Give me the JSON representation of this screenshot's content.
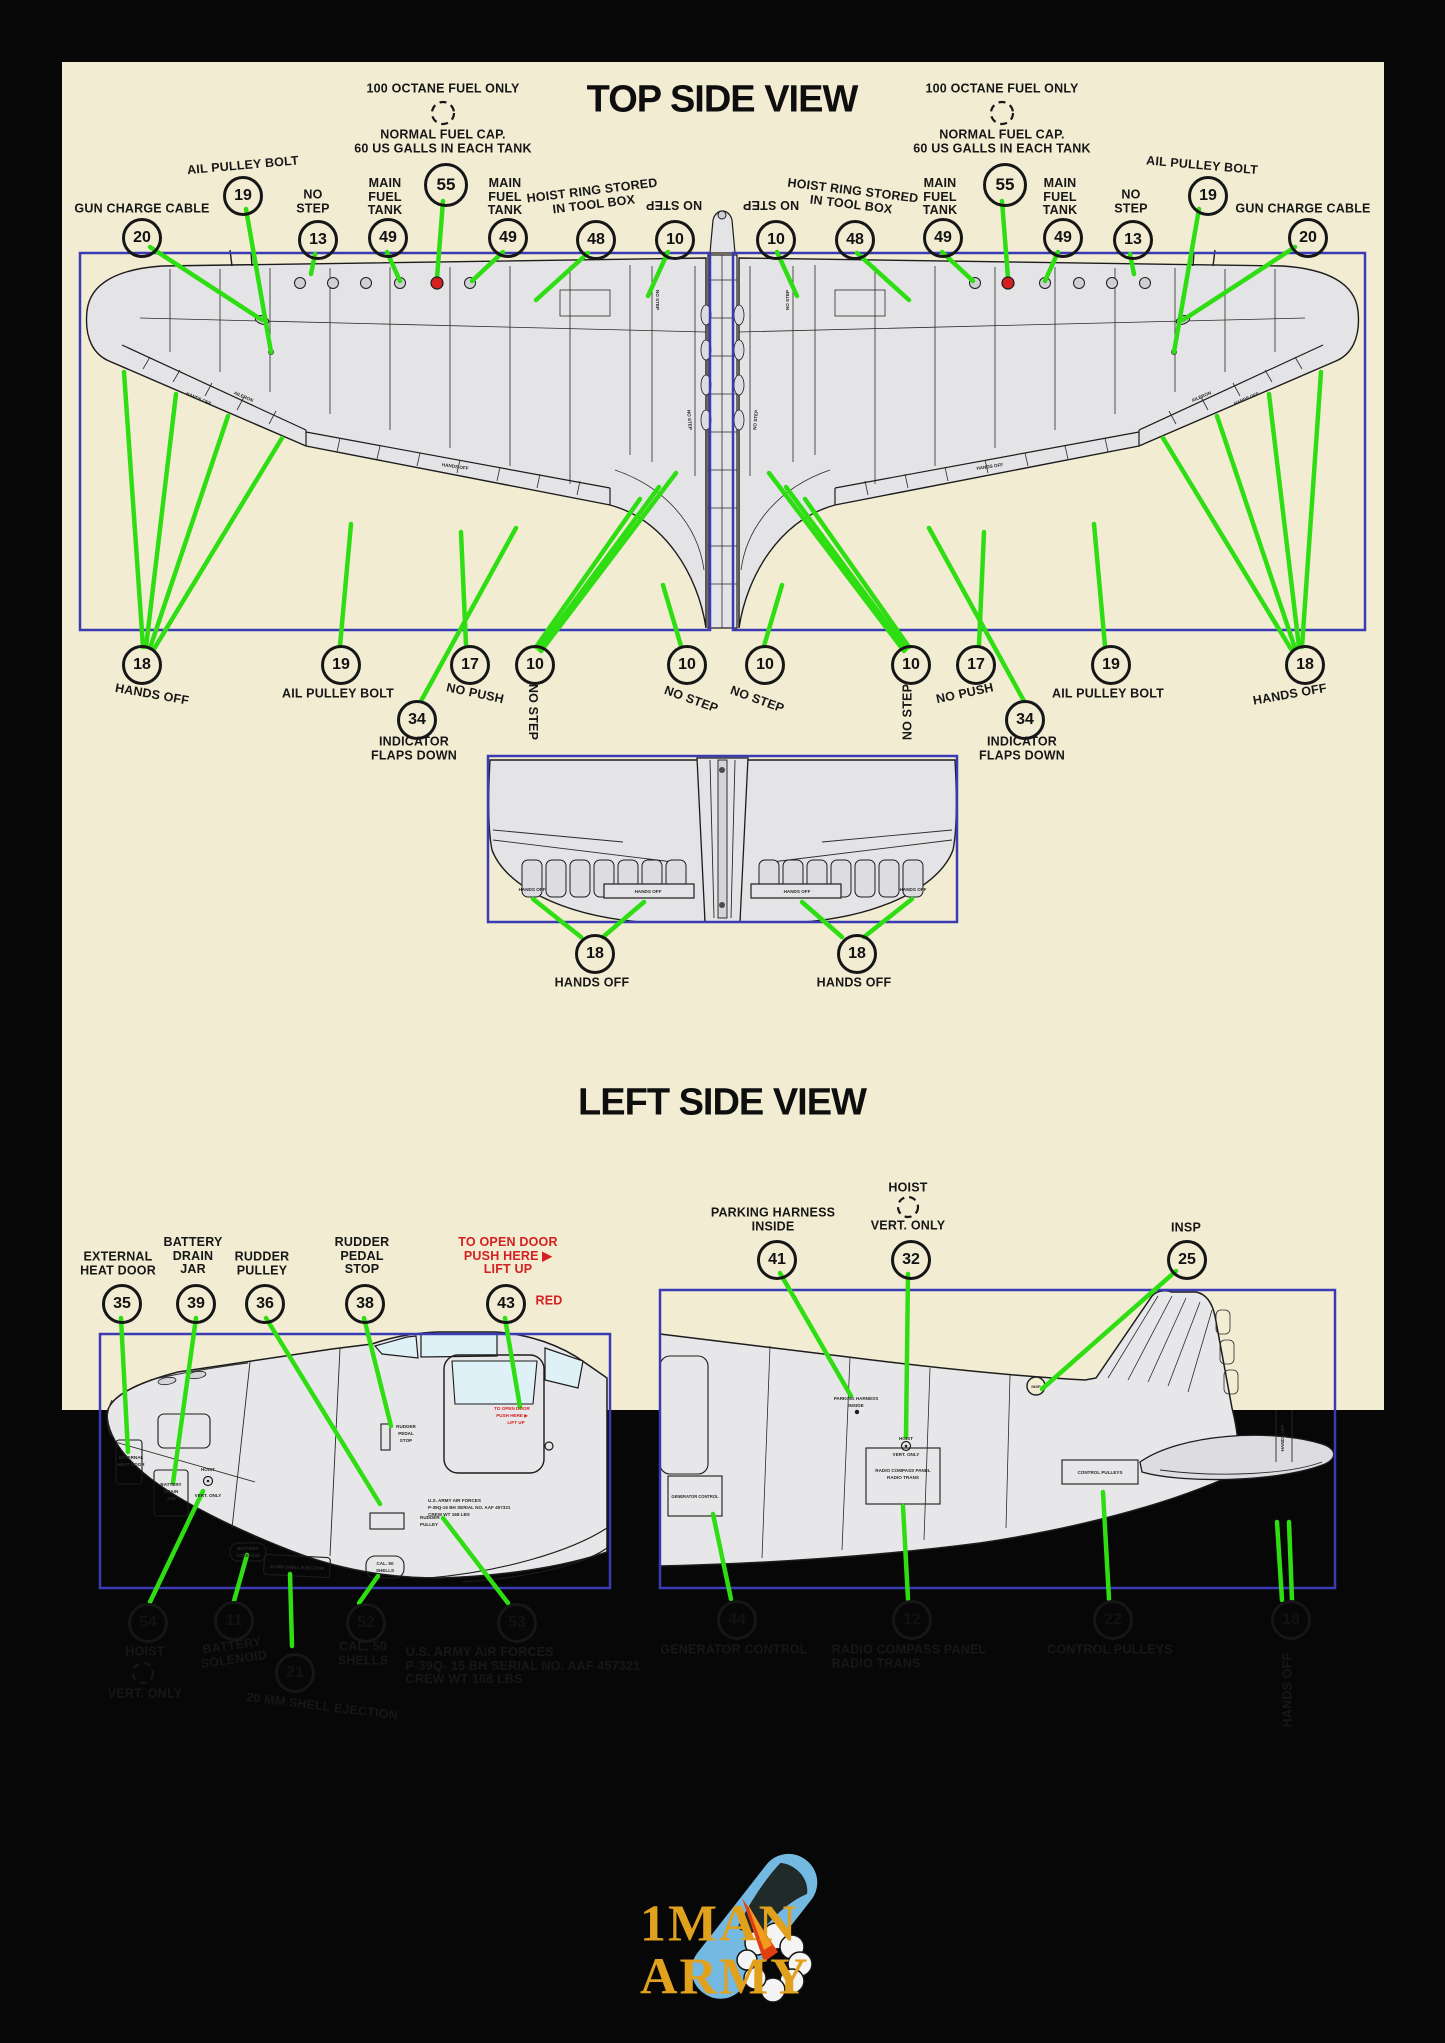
{
  "colors": {
    "bg": "#070707",
    "panel": "#f2ecd3",
    "box_blue": "#3a3ab5",
    "leader_green": "#2fde12",
    "red": "#d42020",
    "ink": "#171717",
    "drawing_gray": "#e4e4e7",
    "logo_gold": "#e2a11d",
    "bomb_blue": "#74b9e2"
  },
  "titles": {
    "top": "TOP SIDE VIEW",
    "left": "LEFT SIDE VIEW"
  },
  "logo": {
    "word1": "1MAN",
    "word2": "ARMY"
  },
  "callouts": [
    {
      "n": "20",
      "x": 139,
      "y": 235
    },
    {
      "n": "19",
      "x": 240,
      "y": 193
    },
    {
      "n": "13",
      "x": 315,
      "y": 237
    },
    {
      "n": "49",
      "x": 385,
      "y": 235
    },
    {
      "n": "55",
      "x": 443,
      "y": 182,
      "d": 38
    },
    {
      "n": "49",
      "x": 505,
      "y": 235
    },
    {
      "n": "48",
      "x": 593,
      "y": 237
    },
    {
      "n": "10",
      "x": 672,
      "y": 237
    },
    {
      "n": "10",
      "x": 773,
      "y": 237
    },
    {
      "n": "48",
      "x": 852,
      "y": 237
    },
    {
      "n": "49",
      "x": 940,
      "y": 235
    },
    {
      "n": "55",
      "x": 1002,
      "y": 182,
      "d": 38
    },
    {
      "n": "49",
      "x": 1060,
      "y": 235
    },
    {
      "n": "13",
      "x": 1130,
      "y": 237
    },
    {
      "n": "19",
      "x": 1205,
      "y": 193
    },
    {
      "n": "20",
      "x": 1305,
      "y": 235
    },
    {
      "n": "18",
      "x": 139,
      "y": 662
    },
    {
      "n": "19",
      "x": 338,
      "y": 662
    },
    {
      "n": "34",
      "x": 414,
      "y": 717
    },
    {
      "n": "17",
      "x": 467,
      "y": 662
    },
    {
      "n": "10",
      "x": 532,
      "y": 662
    },
    {
      "n": "10",
      "x": 684,
      "y": 662
    },
    {
      "n": "10",
      "x": 762,
      "y": 662
    },
    {
      "n": "10",
      "x": 908,
      "y": 662
    },
    {
      "n": "17",
      "x": 973,
      "y": 662
    },
    {
      "n": "34",
      "x": 1022,
      "y": 717
    },
    {
      "n": "19",
      "x": 1108,
      "y": 662
    },
    {
      "n": "18",
      "x": 1302,
      "y": 662
    },
    {
      "n": "18",
      "x": 592,
      "y": 951
    },
    {
      "n": "18",
      "x": 854,
      "y": 951
    },
    {
      "n": "35",
      "x": 119,
      "y": 1301
    },
    {
      "n": "39",
      "x": 193,
      "y": 1301
    },
    {
      "n": "36",
      "x": 262,
      "y": 1301
    },
    {
      "n": "38",
      "x": 362,
      "y": 1301
    },
    {
      "n": "43",
      "x": 503,
      "y": 1301
    },
    {
      "n": "41",
      "x": 774,
      "y": 1257
    },
    {
      "n": "32",
      "x": 908,
      "y": 1257
    },
    {
      "n": "25",
      "x": 1184,
      "y": 1257
    },
    {
      "n": "54",
      "x": 145,
      "y": 1620
    },
    {
      "n": "11",
      "x": 231,
      "y": 1618
    },
    {
      "n": "21",
      "x": 292,
      "y": 1670
    },
    {
      "n": "52",
      "x": 363,
      "y": 1620
    },
    {
      "n": "53",
      "x": 514,
      "y": 1620
    },
    {
      "n": "44",
      "x": 734,
      "y": 1617
    },
    {
      "n": "12",
      "x": 909,
      "y": 1617
    },
    {
      "n": "22",
      "x": 1110,
      "y": 1617
    },
    {
      "n": "18",
      "x": 1288,
      "y": 1617
    }
  ],
  "labels": [
    {
      "t": "100 OCTANE FUEL ONLY",
      "x": 443,
      "y": 89
    },
    {
      "t": "100 OCTANE FUEL ONLY",
      "x": 1002,
      "y": 89
    },
    {
      "t": "NORMAL FUEL CAP.\n60 US GALLS IN EACH TANK",
      "x": 443,
      "y": 142
    },
    {
      "t": "NORMAL FUEL CAP.\n60 US GALLS IN EACH TANK",
      "x": 1002,
      "y": 142
    },
    {
      "t": "AIL PULLEY BOLT",
      "x": 243,
      "y": 166,
      "r": -5
    },
    {
      "t": "AIL PULLEY BOLT",
      "x": 1202,
      "y": 166,
      "r": 5
    },
    {
      "t": "GUN CHARGE CABLE",
      "x": 142,
      "y": 209
    },
    {
      "t": "GUN CHARGE CABLE",
      "x": 1303,
      "y": 209
    },
    {
      "t": "NO\nSTEP",
      "x": 313,
      "y": 202
    },
    {
      "t": "NO\nSTEP",
      "x": 1131,
      "y": 202
    },
    {
      "t": "MAIN\nFUEL\nTANK",
      "x": 385,
      "y": 197
    },
    {
      "t": "MAIN\nFUEL\nTANK",
      "x": 505,
      "y": 197
    },
    {
      "t": "MAIN\nFUEL\nTANK",
      "x": 940,
      "y": 197
    },
    {
      "t": "MAIN\nFUEL\nTANK",
      "x": 1060,
      "y": 197
    },
    {
      "t": "HOIST RING STORED\nIN TOOL BOX",
      "x": 593,
      "y": 198,
      "r": -7
    },
    {
      "t": "HOIST RING STORED\nIN TOOL BOX",
      "x": 852,
      "y": 198,
      "r": 7
    },
    {
      "t": "NO STEP",
      "x": 674,
      "y": 204,
      "r": 180
    },
    {
      "t": "NO STEP",
      "x": 771,
      "y": 204,
      "r": 180
    },
    {
      "t": "HANDS OFF",
      "x": 152,
      "y": 695,
      "r": 10
    },
    {
      "t": "HANDS OFF",
      "x": 1290,
      "y": 695,
      "r": -10
    },
    {
      "t": "AIL PULLEY BOLT",
      "x": 338,
      "y": 694
    },
    {
      "t": "AIL PULLEY BOLT",
      "x": 1108,
      "y": 694
    },
    {
      "t": "NO PUSH",
      "x": 475,
      "y": 694,
      "r": 12
    },
    {
      "t": "NO PUSH",
      "x": 965,
      "y": 694,
      "r": -12
    },
    {
      "t": "NO STEP",
      "x": 532,
      "y": 712,
      "r": 90
    },
    {
      "t": "NO STEP",
      "x": 908,
      "y": 712,
      "r": -90
    },
    {
      "t": "NO STEP",
      "x": 691,
      "y": 700,
      "r": 20
    },
    {
      "t": "NO STEP",
      "x": 757,
      "y": 700,
      "r": 20
    },
    {
      "t": "INDICATOR\nFLAPS DOWN",
      "x": 414,
      "y": 749
    },
    {
      "t": "INDICATOR\nFLAPS DOWN",
      "x": 1022,
      "y": 749
    },
    {
      "t": "HANDS OFF",
      "x": 592,
      "y": 983
    },
    {
      "t": "HANDS OFF",
      "x": 854,
      "y": 983
    },
    {
      "t": "EXTERNAL\nHEAT DOOR",
      "x": 118,
      "y": 1264
    },
    {
      "t": "BATTERY\nDRAIN\nJAR",
      "x": 193,
      "y": 1256
    },
    {
      "t": "RUDDER\nPULLEY",
      "x": 262,
      "y": 1264
    },
    {
      "t": "RUDDER\nPEDAL\nSTOP",
      "x": 362,
      "y": 1256
    },
    {
      "t": "TO OPEN DOOR\nPUSH HERE ▶\nLIFT UP",
      "x": 508,
      "y": 1256,
      "c": "red"
    },
    {
      "t": "RED",
      "x": 549,
      "y": 1301,
      "c": "red"
    },
    {
      "t": "PARKING HARNESS\nINSIDE",
      "x": 773,
      "y": 1220
    },
    {
      "t": "HOIST",
      "x": 908,
      "y": 1188
    },
    {
      "t": "VERT. ONLY",
      "x": 908,
      "y": 1226
    },
    {
      "t": "INSP",
      "x": 1186,
      "y": 1228
    },
    {
      "t": "HOIST",
      "x": 145,
      "y": 1652
    },
    {
      "t": "VERT. ONLY",
      "x": 145,
      "y": 1694
    },
    {
      "t": "BATTERY\nSOLENOID",
      "x": 233,
      "y": 1653,
      "r": -8
    },
    {
      "t": "20 MM SHELL EJECTION",
      "x": 322,
      "y": 1707,
      "r": 7
    },
    {
      "t": "CAL. 50\nSHELLS",
      "x": 363,
      "y": 1654
    },
    {
      "t": "U.S. ARMY AIR FORCES\nP-39Q- 15 BH SERIAL NO. AAF 457321\nCREW WT  168 LBS",
      "x": 523,
      "y": 1666,
      "a": "left"
    },
    {
      "t": "GENERATOR CONTROL",
      "x": 734,
      "y": 1650
    },
    {
      "t": "RADIO COMPASS PANEL\nRADIO TRANS",
      "x": 909,
      "y": 1657,
      "a": "left"
    },
    {
      "t": "CONTROL PULLEYS",
      "x": 1110,
      "y": 1650
    },
    {
      "t": "HANDS OFF",
      "x": 1288,
      "y": 1690,
      "r": -90
    }
  ],
  "leader_lines": [
    [
      150,
      247,
      262,
      320
    ],
    [
      246,
      209,
      271,
      352
    ],
    [
      315,
      254,
      311,
      274
    ],
    [
      387,
      252,
      400,
      281
    ],
    [
      443,
      201,
      437,
      278
    ],
    [
      503,
      252,
      472,
      281
    ],
    [
      588,
      253,
      536,
      300
    ],
    [
      668,
      252,
      648,
      296
    ],
    [
      777,
      252,
      797,
      296
    ],
    [
      857,
      253,
      909,
      300
    ],
    [
      942,
      252,
      973,
      281
    ],
    [
      1002,
      201,
      1008,
      278
    ],
    [
      1058,
      252,
      1045,
      281
    ],
    [
      1130,
      254,
      1134,
      274
    ],
    [
      1199,
      209,
      1174,
      352
    ],
    [
      1295,
      247,
      1183,
      320
    ],
    [
      143,
      647,
      124,
      372
    ],
    [
      146,
      647,
      176,
      394
    ],
    [
      150,
      648,
      228,
      416
    ],
    [
      154,
      649,
      282,
      438
    ],
    [
      340,
      646,
      351,
      524
    ],
    [
      421,
      701,
      516,
      528
    ],
    [
      466,
      645,
      461,
      532
    ],
    [
      536,
      647,
      640,
      499
    ],
    [
      539,
      649,
      659,
      487
    ],
    [
      541,
      651,
      676,
      473
    ],
    [
      681,
      646,
      663,
      585
    ],
    [
      764,
      646,
      782,
      585
    ],
    [
      909,
      647,
      805,
      499
    ],
    [
      906,
      649,
      786,
      487
    ],
    [
      904,
      651,
      769,
      473
    ],
    [
      979,
      645,
      984,
      532
    ],
    [
      1024,
      701,
      929,
      528
    ],
    [
      1105,
      646,
      1094,
      524
    ],
    [
      1302,
      647,
      1321,
      372
    ],
    [
      1299,
      647,
      1269,
      394
    ],
    [
      1295,
      648,
      1217,
      416
    ],
    [
      1291,
      649,
      1163,
      438
    ],
    [
      581,
      937,
      533,
      899
    ],
    [
      603,
      937,
      644,
      902
    ],
    [
      842,
      937,
      802,
      902
    ],
    [
      864,
      937,
      912,
      899
    ],
    [
      121,
      1318,
      128,
      1452
    ],
    [
      196,
      1318,
      173,
      1483
    ],
    [
      266,
      1318,
      380,
      1504
    ],
    [
      364,
      1318,
      391,
      1426
    ],
    [
      505,
      1318,
      520,
      1407
    ],
    [
      780,
      1273,
      851,
      1396
    ],
    [
      908,
      1274,
      906,
      1437
    ],
    [
      1176,
      1271,
      1042,
      1389
    ],
    [
      150,
      1602,
      203,
      1491
    ],
    [
      234,
      1601,
      247,
      1555
    ],
    [
      292,
      1646,
      290,
      1574
    ],
    [
      359,
      1603,
      378,
      1576
    ],
    [
      508,
      1603,
      443,
      1518
    ],
    [
      731,
      1599,
      713,
      1514
    ],
    [
      908,
      1599,
      903,
      1506
    ],
    [
      1109,
      1599,
      1103,
      1492
    ],
    [
      1282,
      1600,
      1277,
      1522
    ],
    [
      1292,
      1600,
      1289,
      1522
    ]
  ],
  "dashed_circles": [
    [
      443,
      113,
      11
    ],
    [
      1002,
      113,
      11
    ],
    [
      908,
      1207,
      10
    ],
    [
      143,
      1673,
      10
    ]
  ],
  "fuel_caps": [
    [
      437,
      283
    ],
    [
      1008,
      283
    ]
  ],
  "micro_labels": [
    {
      "t": "HANDS OFF",
      "x": 198,
      "y": 400,
      "r": 23
    },
    {
      "t": "AILERON",
      "x": 243,
      "y": 398,
      "r": 23
    },
    {
      "t": "HANDS OFF",
      "x": 455,
      "y": 468,
      "r": 8
    },
    {
      "t": "NO STEP",
      "x": 656,
      "y": 300,
      "r": 90
    },
    {
      "t": "NO STEP",
      "x": 688,
      "y": 420,
      "r": 85
    },
    {
      "t": "HANDS OFF",
      "x": 1247,
      "y": 400,
      "r": -23
    },
    {
      "t": "AILERON",
      "x": 1202,
      "y": 398,
      "r": -23
    },
    {
      "t": "HANDS OFF",
      "x": 990,
      "y": 468,
      "r": -8
    },
    {
      "t": "NO STEP",
      "x": 789,
      "y": 300,
      "r": -90
    },
    {
      "t": "NO STEP",
      "x": 757,
      "y": 420,
      "r": -85
    },
    {
      "t": "HANDS OFF",
      "x": 532,
      "y": 891
    },
    {
      "t": "HANDS OFF",
      "x": 648,
      "y": 893
    },
    {
      "t": "HANDS OFF",
      "x": 797,
      "y": 893
    },
    {
      "t": "HANDS OFF",
      "x": 913,
      "y": 891
    },
    {
      "t": "EXTERNAL",
      "x": 131,
      "y": 1459
    },
    {
      "t": "HEAT DOOR",
      "x": 131,
      "y": 1466
    },
    {
      "t": "BATTERY",
      "x": 171,
      "y": 1486
    },
    {
      "t": "DRAIN",
      "x": 171,
      "y": 1493
    },
    {
      "t": "JAR",
      "x": 171,
      "y": 1500
    },
    {
      "t": "HOIST",
      "x": 208,
      "y": 1471
    },
    {
      "t": "VERT. ONLY",
      "x": 208,
      "y": 1497
    },
    {
      "t": "RUDDER",
      "x": 406,
      "y": 1428
    },
    {
      "t": "PEDAL",
      "x": 406,
      "y": 1435
    },
    {
      "t": "STOP",
      "x": 406,
      "y": 1442
    },
    {
      "t": "TO OPEN DOOR",
      "x": 512,
      "y": 1410,
      "c": "red"
    },
    {
      "t": "PUSH HERE ▶",
      "x": 512,
      "y": 1417,
      "c": "red"
    },
    {
      "t": "LIFT UP",
      "x": 516,
      "y": 1424,
      "c": "red"
    },
    {
      "t": "U.S. ARMY AIR FORCES",
      "x": 428,
      "y": 1502,
      "a": "start"
    },
    {
      "t": "P-39Q-15 BH SERIAL NO. AAF 457321",
      "x": 428,
      "y": 1509,
      "a": "start"
    },
    {
      "t": "CREW WT 168 LBS",
      "x": 428,
      "y": 1516,
      "a": "start"
    },
    {
      "t": "RUDDER",
      "x": 420,
      "y": 1519,
      "a": "start"
    },
    {
      "t": "PULLEY",
      "x": 420,
      "y": 1526,
      "a": "start"
    },
    {
      "t": "BATTERY",
      "x": 248,
      "y": 1550
    },
    {
      "t": "SOLENOID",
      "x": 248,
      "y": 1557
    },
    {
      "t": "20 MM SHELL EJECTION",
      "x": 297,
      "y": 1569,
      "r": 2
    },
    {
      "t": "CAL. 50",
      "x": 385,
      "y": 1565
    },
    {
      "t": "SHELLS",
      "x": 385,
      "y": 1572
    },
    {
      "t": "PARKING HARNESS",
      "x": 856,
      "y": 1400
    },
    {
      "t": "INSIDE",
      "x": 856,
      "y": 1407
    },
    {
      "t": "HOIST",
      "x": 906,
      "y": 1440
    },
    {
      "t": "VERT. ONLY",
      "x": 906,
      "y": 1456
    },
    {
      "t": "GENERATOR CONTROL",
      "x": 695,
      "y": 1498,
      "s": 4.1
    },
    {
      "t": "RADIO COMPASS PANEL",
      "x": 903,
      "y": 1472
    },
    {
      "t": "RADIO TRANS",
      "x": 903,
      "y": 1479
    },
    {
      "t": "CONTROL PULLEYS",
      "x": 1100,
      "y": 1474
    },
    {
      "t": "INSP",
      "x": 1036,
      "y": 1388,
      "s": 4
    },
    {
      "t": "HANDS OFF",
      "x": 1284,
      "y": 1438,
      "r": -90
    }
  ]
}
